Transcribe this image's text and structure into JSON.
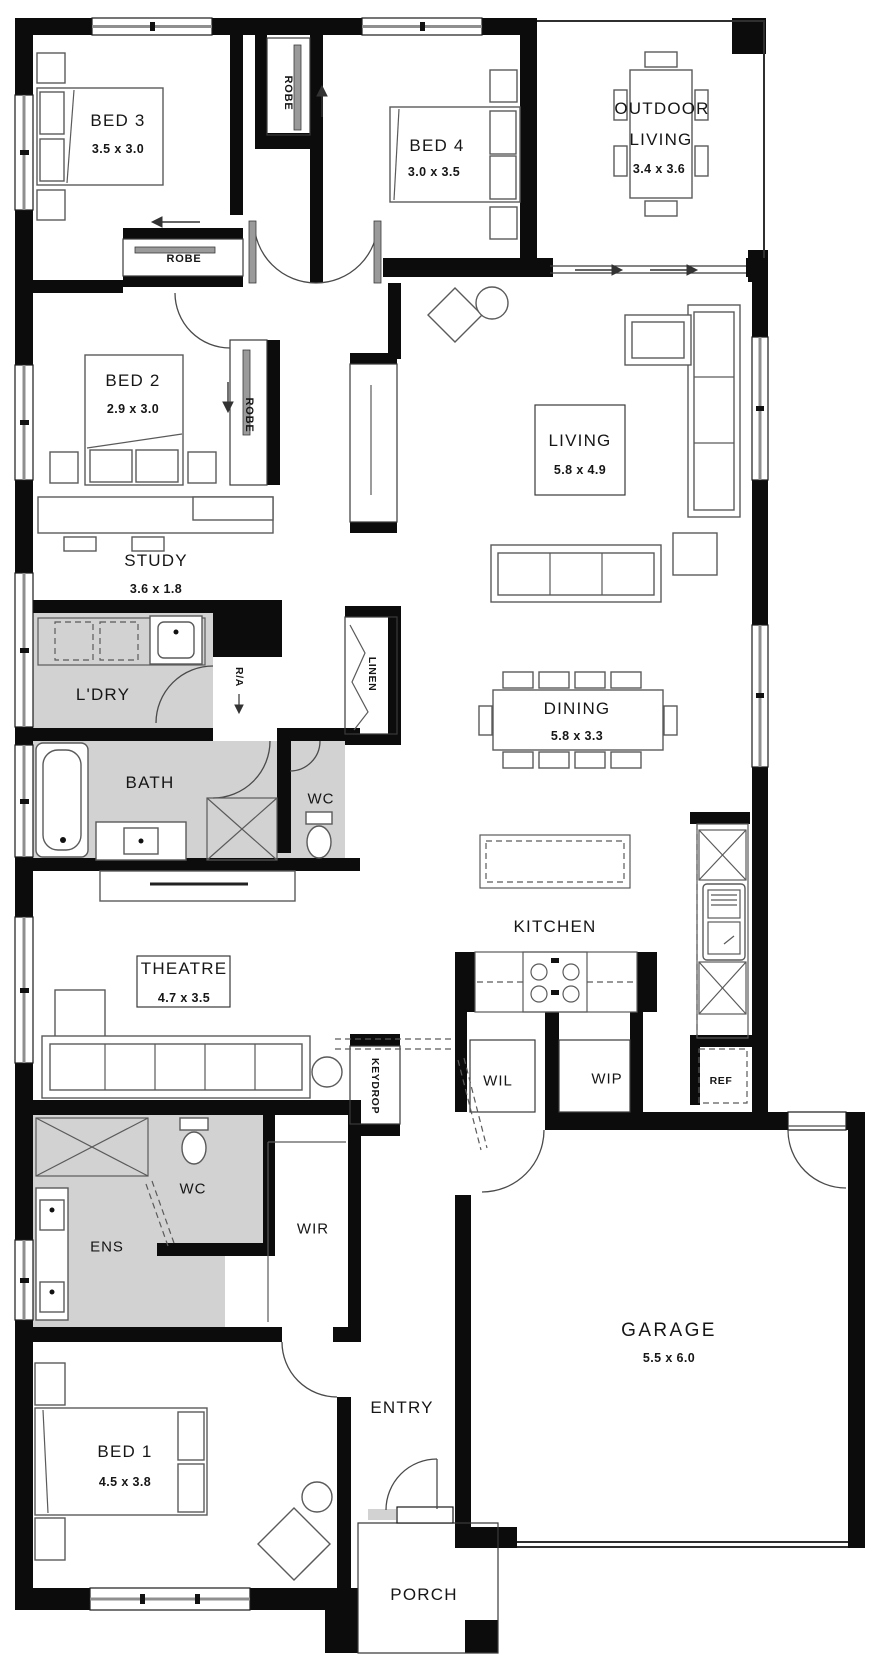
{
  "colors": {
    "wall": "#0c0c0c",
    "wet_area_fill": "#d2d2d2",
    "furniture_line": "#5a5a5a",
    "background": "#ffffff"
  },
  "rooms": [
    {
      "id": "bed3",
      "name": "BED 3",
      "dims": "3.5 x 3.0"
    },
    {
      "id": "robe-top",
      "name": "ROBE"
    },
    {
      "id": "bed4",
      "name": "BED 4",
      "dims": "3.0 x 3.5"
    },
    {
      "id": "outdoor-living",
      "name_line1": "OUTDOOR",
      "name_line2": "LIVING",
      "dims": "3.4 x 3.6"
    },
    {
      "id": "robe-bed3",
      "name": "ROBE"
    },
    {
      "id": "bed2",
      "name": "BED 2",
      "dims": "2.9 x 3.0"
    },
    {
      "id": "robe-bed2",
      "name": "ROBE"
    },
    {
      "id": "study",
      "name": "STUDY",
      "dims": "3.6 x 1.8"
    },
    {
      "id": "living",
      "name": "LIVING",
      "dims": "5.8 x 4.9"
    },
    {
      "id": "laundry",
      "name": "L'DRY"
    },
    {
      "id": "return-air",
      "name": "R/A"
    },
    {
      "id": "linen",
      "name": "LINEN"
    },
    {
      "id": "bath",
      "name": "BATH"
    },
    {
      "id": "wc-main",
      "name": "WC"
    },
    {
      "id": "dining",
      "name": "DINING",
      "dims": "5.8 x 3.3"
    },
    {
      "id": "kitchen",
      "name": "KITCHEN"
    },
    {
      "id": "theatre",
      "name": "THEATRE",
      "dims": "4.7 x 3.5"
    },
    {
      "id": "keydrop",
      "name": "KEYDROP"
    },
    {
      "id": "wil",
      "name": "WIL"
    },
    {
      "id": "wip",
      "name": "WIP"
    },
    {
      "id": "ref",
      "name": "REF"
    },
    {
      "id": "wc-ens",
      "name": "WC"
    },
    {
      "id": "ens",
      "name": "ENS"
    },
    {
      "id": "wir",
      "name": "WIR"
    },
    {
      "id": "garage",
      "name": "GARAGE",
      "dims": "5.5 x 6.0"
    },
    {
      "id": "bed1",
      "name": "BED 1",
      "dims": "4.5 x 3.8"
    },
    {
      "id": "entry",
      "name": "ENTRY"
    },
    {
      "id": "porch",
      "name": "PORCH"
    }
  ]
}
